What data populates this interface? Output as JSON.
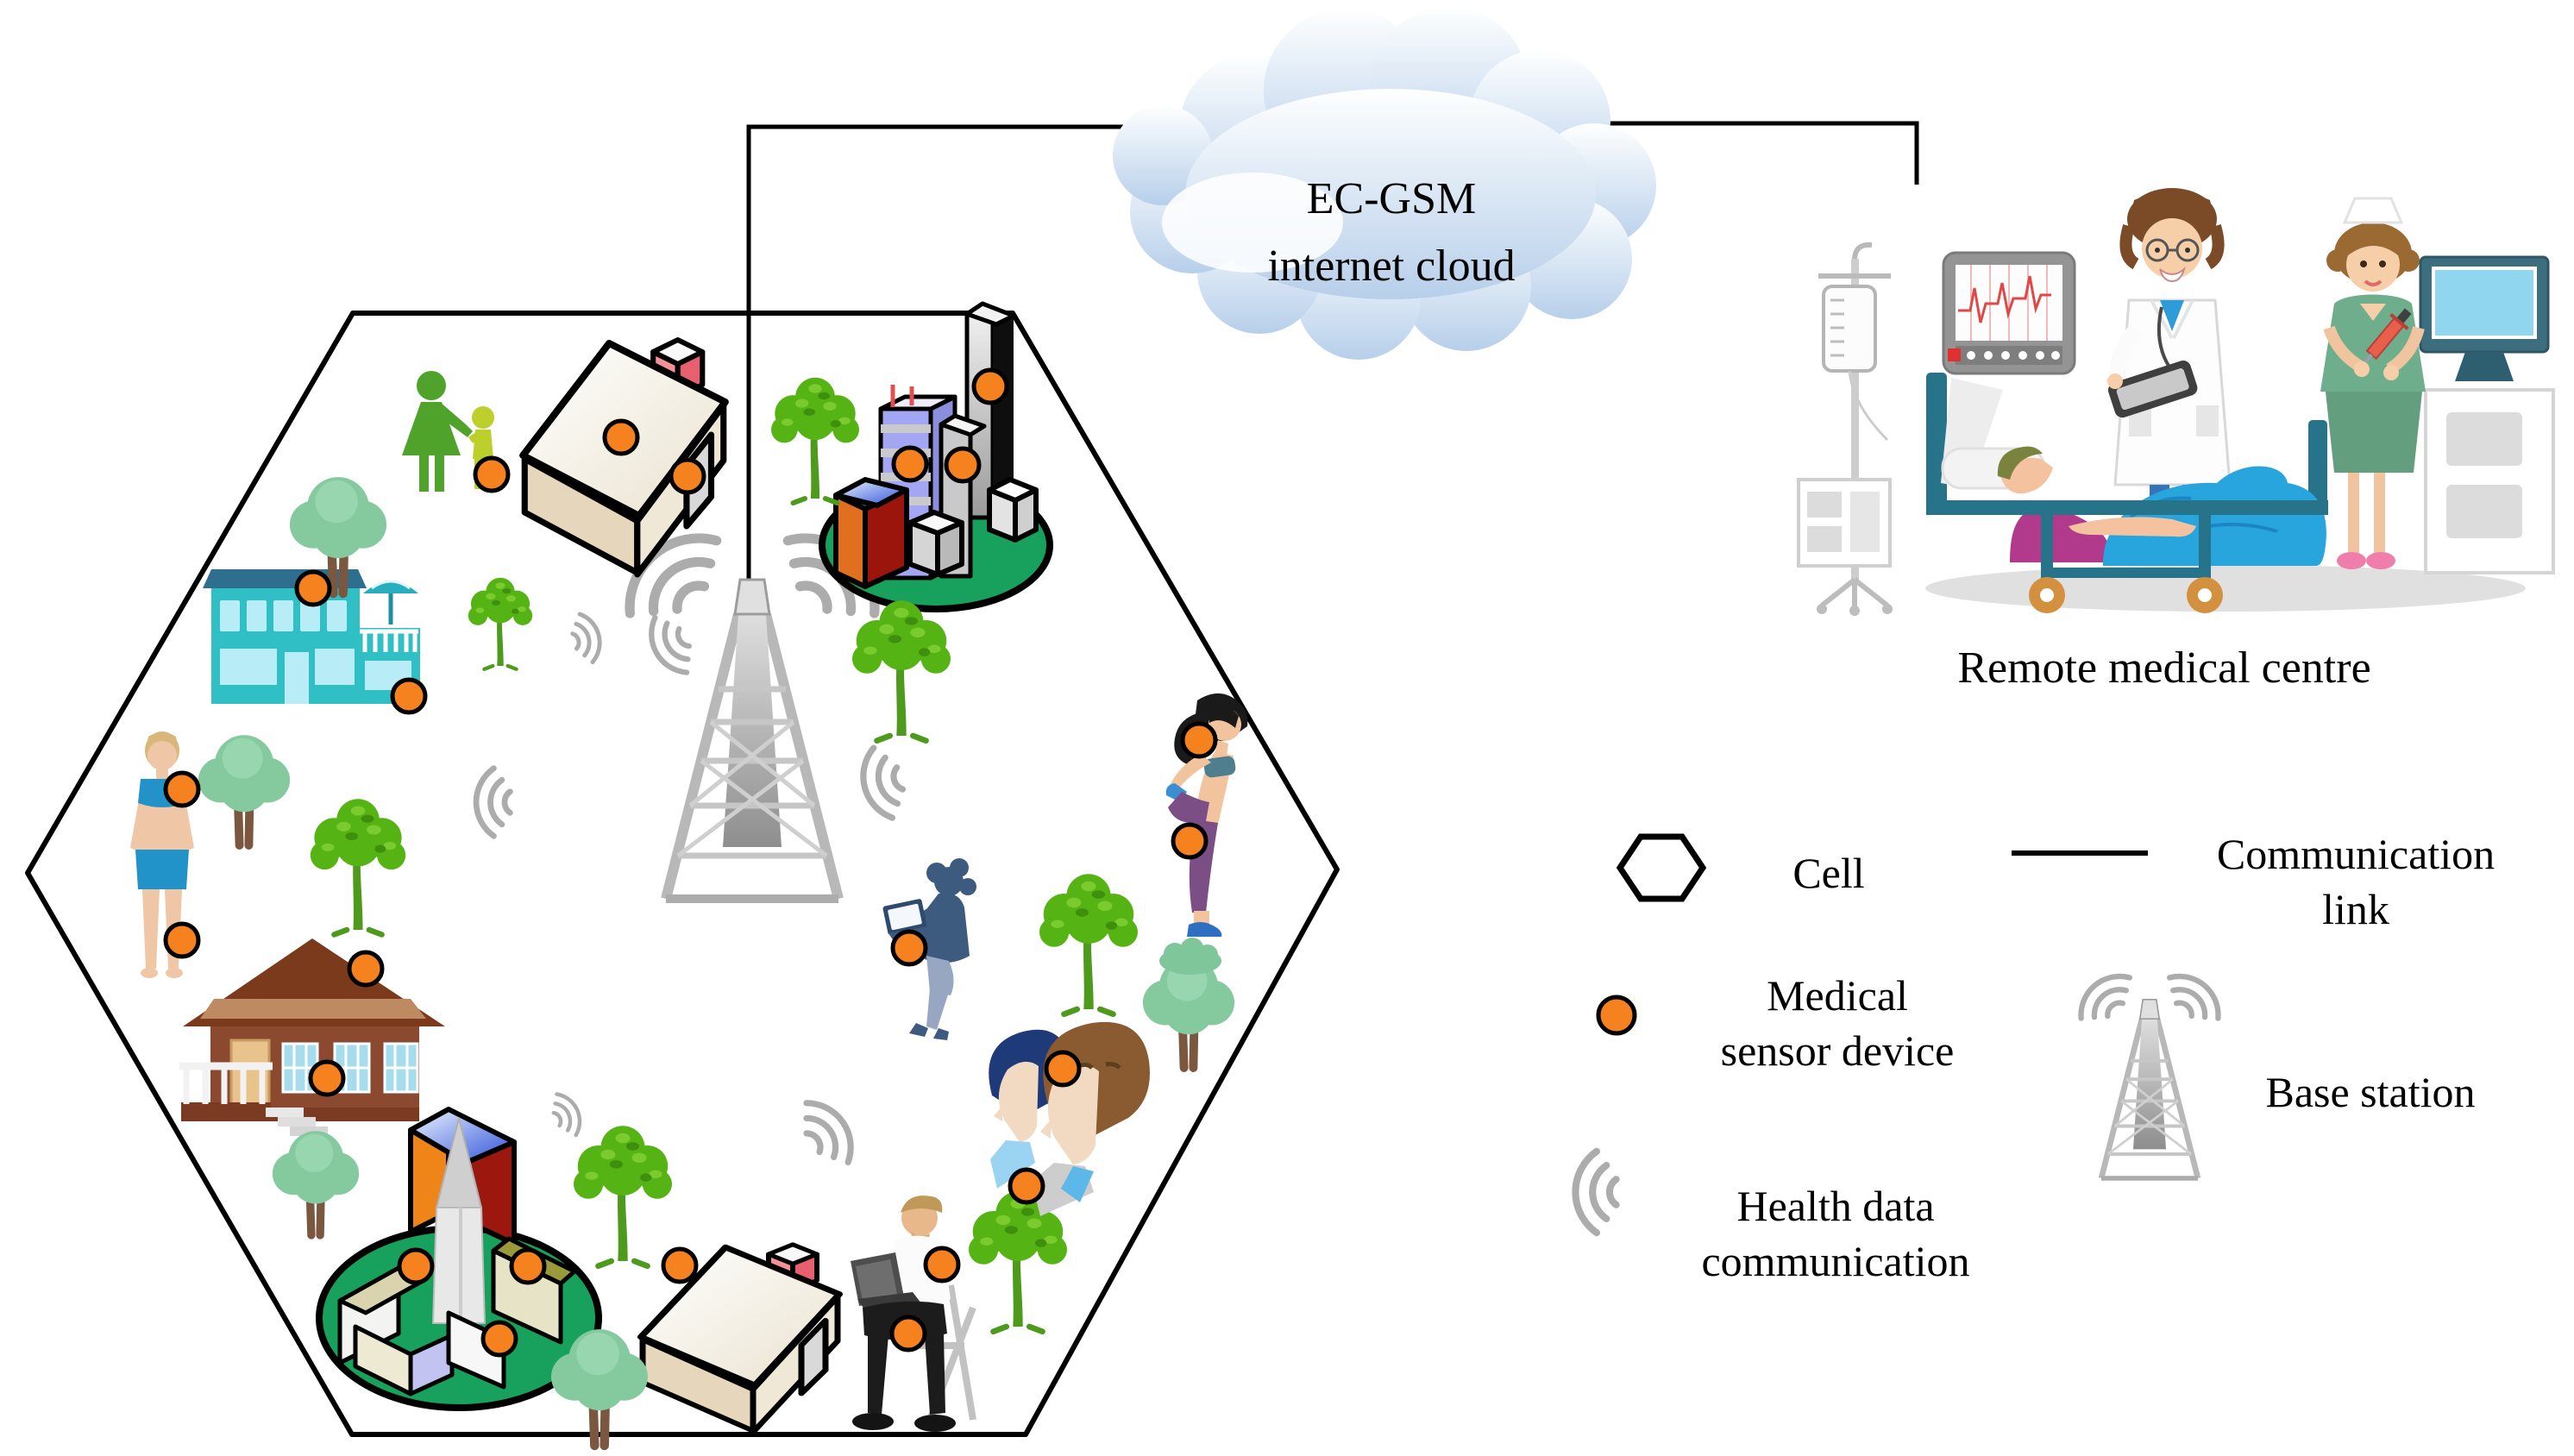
{
  "cloud": {
    "line1": "EC-GSM",
    "line2": "internet cloud"
  },
  "remote_medical_centre": {
    "label": "Remote medical centre"
  },
  "legend": {
    "cell": {
      "label": "Cell"
    },
    "communication_link": {
      "line1": "Communication",
      "line2": "link"
    },
    "medical_sensor_device": {
      "line1": "Medical",
      "line2": "sensor device"
    },
    "base_station": {
      "label": "Base station"
    },
    "health_data_communication": {
      "line1": "Health data",
      "line2": "communication"
    }
  },
  "colors": {
    "sensor_device": "#F5821F",
    "sensor_outline": "#000000",
    "cell_outline": "#000000",
    "communication_link": "#000000",
    "signal_arc": "#ACACAC",
    "cloud_fill_top": "#FEFFFF",
    "cloud_fill_bottom": "#B7CFEA",
    "ground_ellipse_green": "#17A15C",
    "tree_bright_green": "#55B314",
    "tree_soft_green": "#85CA9E",
    "hotel_teal": "#2FBFC4",
    "cabin_brown": "#8B4A2F",
    "bed_teal": "#27748A",
    "blanket_blue": "#29A5DD"
  },
  "counts": {
    "medical_sensor_devices_in_cell": 23,
    "signal_arc_groups_in_cell": 6,
    "buildings_in_cell": 6,
    "people_groups_in_cell": 6
  }
}
